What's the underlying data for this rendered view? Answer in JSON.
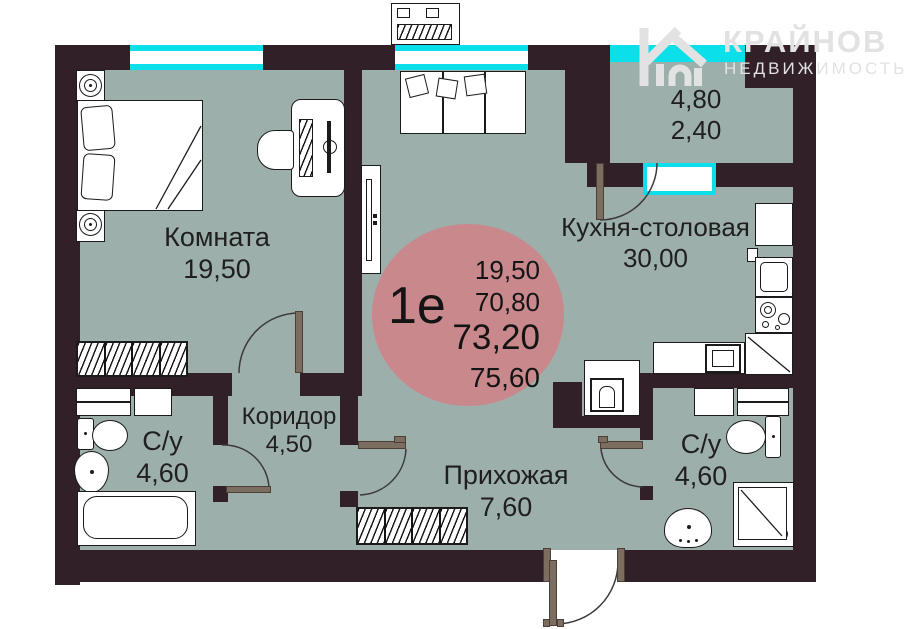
{
  "watermark": {
    "brand": "КРАЙНОВ",
    "subtitle": "НЕДВИЖИМОСТЬ"
  },
  "unit_badge": {
    "type": "1е",
    "areas": [
      "19,50",
      "70,80",
      "73,20",
      "75,60"
    ]
  },
  "rooms": {
    "bedroom": {
      "name": "Комната",
      "area": "19,50"
    },
    "kitchen": {
      "name": "Кухня-столовая",
      "area": "30,00"
    },
    "corridor": {
      "name": "Коридор",
      "area": "4,50"
    },
    "hallway": {
      "name": "Прихожая",
      "area": "7,60"
    },
    "bathroom_left": {
      "name": "С/у",
      "area": "4,60"
    },
    "bathroom_right": {
      "name": "С/у",
      "area": "4,60"
    },
    "balcony": {
      "area": "4,80",
      "area_reduced": "2,40"
    }
  },
  "colors": {
    "floor": "#9DAFAA",
    "wall": "#312028",
    "window": "#0BDFEA",
    "badge": "#C9888C",
    "door": "#7B6D60",
    "text": "#1F1F1F",
    "watermark": "#E2E2E2"
  }
}
